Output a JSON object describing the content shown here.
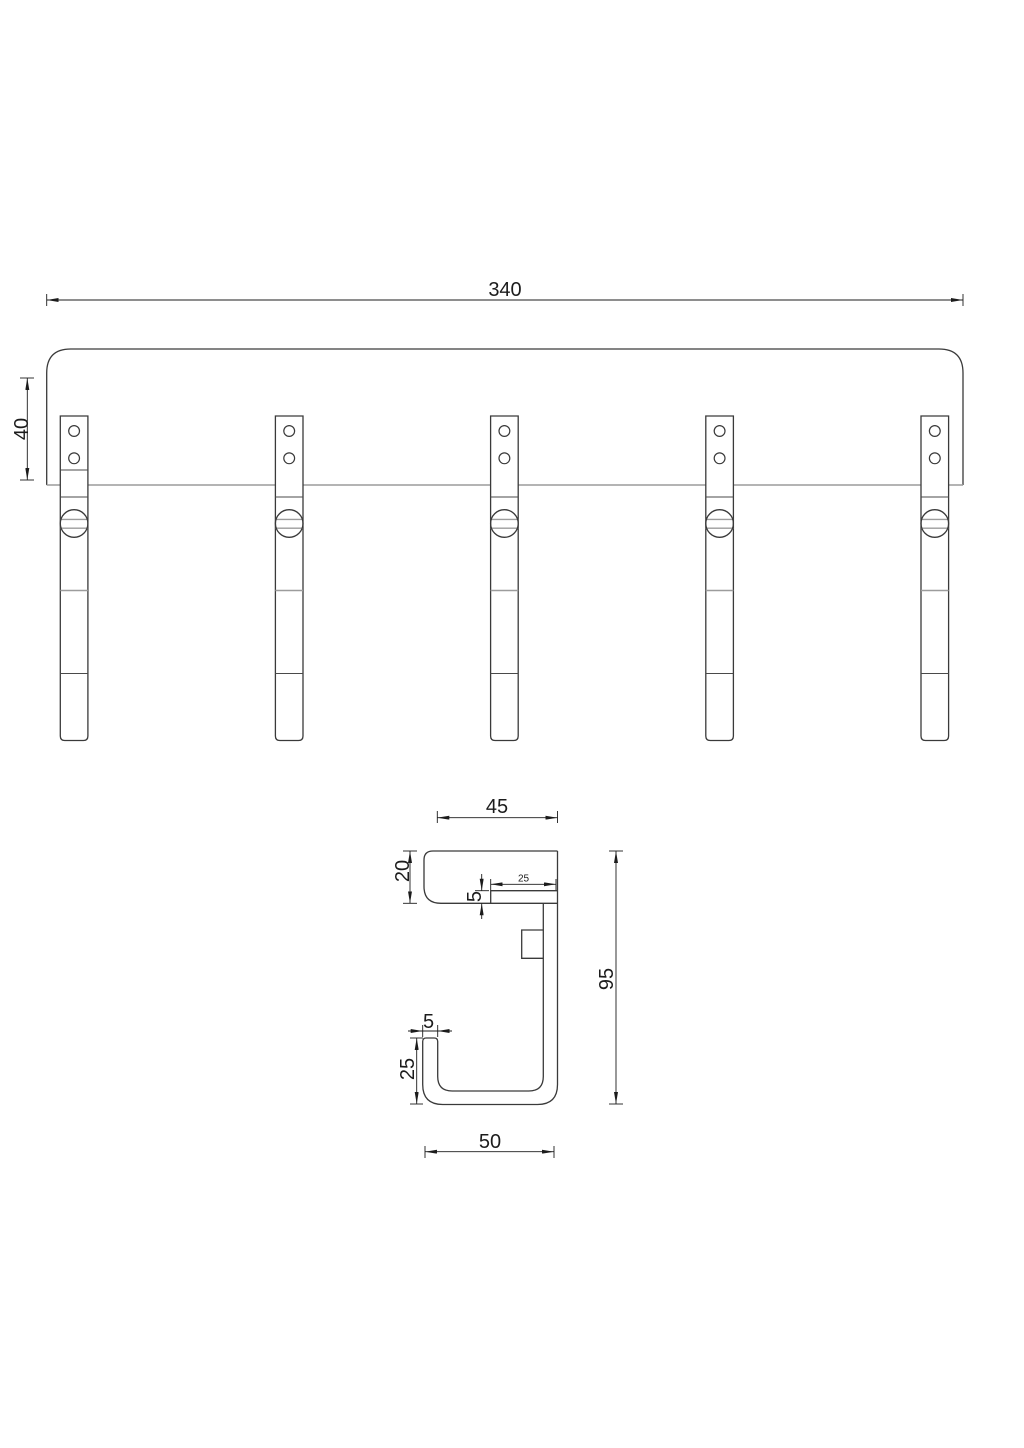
{
  "drawing": {
    "background": "#ffffff",
    "front_view": {
      "hook_count": 5,
      "dims": {
        "overall_width": "340",
        "rail_height": "40"
      }
    },
    "side_view": {
      "dims": {
        "rail_depth": "45",
        "rail_thickness": "20",
        "arm_length": "25",
        "arm_thickness": "5",
        "overall_height": "95",
        "tip_thickness": "5",
        "tip_height": "25",
        "hook_depth": "50"
      }
    },
    "colors": {
      "outline": "#3a3a3a",
      "light_line": "#9c9c9c",
      "dimension": "#1c1c1c"
    }
  }
}
